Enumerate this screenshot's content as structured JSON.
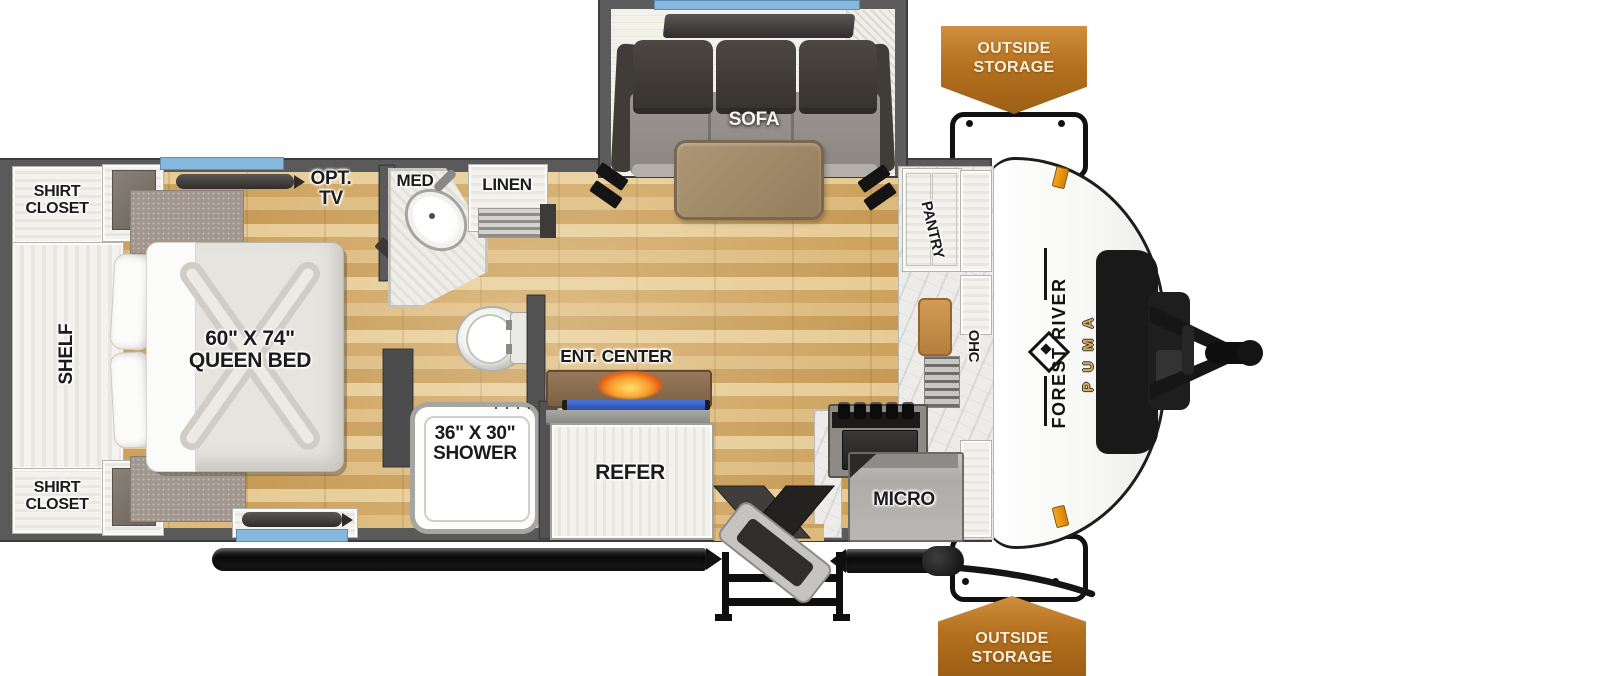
{
  "floorplan": {
    "type": "travel-trailer-floorplan",
    "brand": {
      "manufacturer": "FOREST RIVER",
      "model": "PUMA"
    },
    "labels": {
      "shirt_closet_top": "SHIRT\nCLOSET",
      "shelf": "SHELF",
      "shirt_closet_bottom": "SHIRT\nCLOSET",
      "queen_bed": "60\" X 74\"\nQUEEN BED",
      "opt_tv": "OPT.\nTV",
      "med": "MED",
      "linen": "LINEN",
      "shower": "36\" X 30\"\nSHOWER",
      "ent_center": "ENT. CENTER",
      "refer": "REFER",
      "sofa": "SOFA",
      "pantry": "PANTRY",
      "ohc": "OHC",
      "micro": "MICRO"
    },
    "badges": {
      "top": "OUTSIDE\nSTORAGE",
      "bottom": "OUTSIDE\nSTORAGE"
    },
    "colors": {
      "window_accent": "#86b7dc",
      "badge_orange": "#b4711f",
      "brand_gold": "#d9a961",
      "wall_gray": "#5a5a5a"
    }
  }
}
